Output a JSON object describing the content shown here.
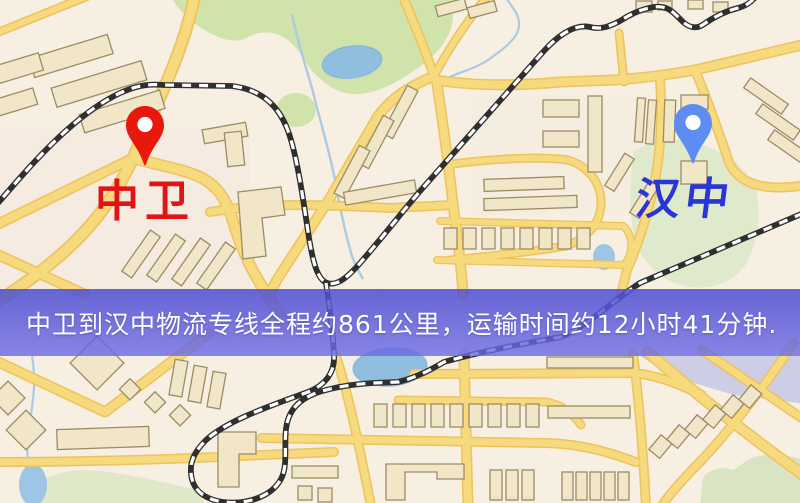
{
  "banner": {
    "text": "中卫到汉中物流专线全程约861公里，运输时间约12小时41分钟.",
    "background": "#5c5cd9",
    "text_color": "#ffffff"
  },
  "markers": {
    "origin": {
      "label": "中卫",
      "pin_color": "#e8190c",
      "label_color": "#e01414"
    },
    "destination": {
      "label": "汉中",
      "pin_color": "#5d8cf2",
      "label_color": "#2a35d8"
    }
  },
  "icons": {
    "origin_marker": "red-map-pin-icon",
    "destination_marker": "blue-map-pin-icon"
  },
  "map_colors": {
    "background": "#f7efe2",
    "road_fill": "#f7d97e",
    "road_edge": "#ecc35e",
    "railway": "#2f2f2f",
    "park_green": "#cfe3ab",
    "water_blue": "#8fbede",
    "building_fill": "#f1e6c8",
    "building_outline": "#9b8c66"
  }
}
